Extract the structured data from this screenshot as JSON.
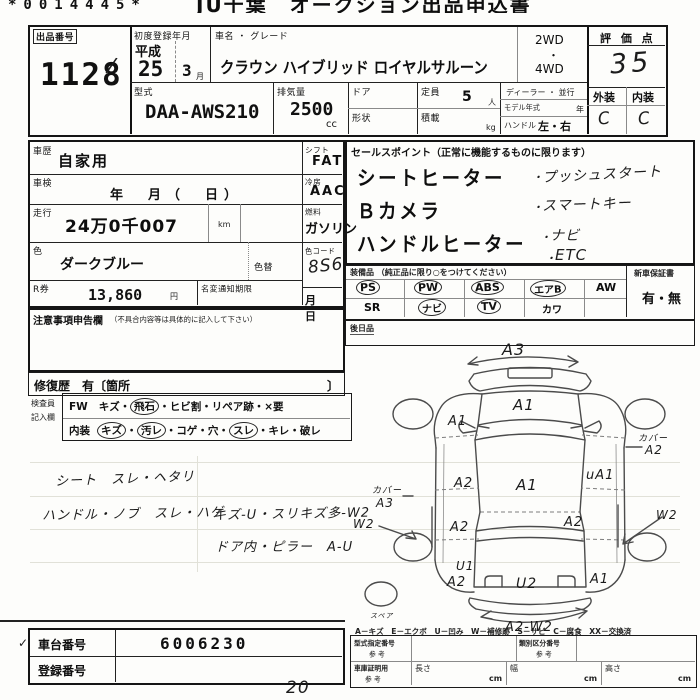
{
  "page": {
    "serial": "*0014445*",
    "title": "JU千葉　オークション出品申込書",
    "page_number": "20"
  },
  "head": {
    "lot_label": "出品番号",
    "lot": "1128",
    "check": "∕",
    "firstreg_label": "初度登録年月",
    "era": "平成",
    "year": "25",
    "month": "3",
    "month_unit": "月",
    "name_label": "車名 ・ グレード",
    "name": "クラウン ハイブリッド ロイヤルサルーン",
    "wd2": "2WD",
    "dot": "・",
    "wd4": "4WD",
    "score_label": "評 価 点",
    "score": "35",
    "model_label": "型式",
    "model": "DAA-AWS210",
    "disp_label": "排気量",
    "disp": "2500",
    "disp_unit": "cc",
    "door_label": "ドア",
    "shape_label": "形状",
    "cap_label": "定員",
    "cap": "5",
    "cap_unit": "人",
    "load_label": "積載",
    "load_unit": "kg",
    "dealer_label": "ディーラー ・ 並行",
    "modelyear_label": "モデル年式",
    "year_unit": "年",
    "handle_label": "ハンドル",
    "handle": "左・右",
    "ext_label": "外装",
    "int_label": "内装",
    "ext": "C",
    "int": "C"
  },
  "mid": {
    "history_label": "車歴",
    "history": "自家用",
    "shift_label": "シフト",
    "shift": "FAT",
    "shaken_label": "車検",
    "shaken": "年　月（　日）",
    "ac_label": "冷房",
    "ac": "AAC",
    "mileage_label": "走行",
    "mileage": "24万0千007",
    "mileage_unit": "km",
    "fuel_label": "燃料",
    "fuel": "ガソリン",
    "color_label": "色",
    "color": "ダークブルー",
    "colorchg_label": "色替",
    "colorcode_label": "色コード",
    "colorcode": "8S6",
    "rticket_label": "R券",
    "rticket": "13,860",
    "yen_unit": "円",
    "meihen_label": "名変通知期限",
    "meihen": "月　　日",
    "notes_label": "注意事項申告欄",
    "notes_sub": "（不具合内容等は具体的に記入して下さい）",
    "repair": "修復歴　有〔箇所",
    "repair_close": "〕"
  },
  "sales": {
    "header": "セールスポイント（正常に機能するものに限ります）",
    "printed": [
      "シートヒーター",
      "Ｂカメラ",
      "ハンドルヒーター"
    ],
    "bullet": "・",
    "written": [
      "プッシュスタート",
      "スマートキー",
      "ナビ",
      "ETC"
    ]
  },
  "equip": {
    "header": "装備品 （純正品に限り○をつけてください）",
    "row1": [
      "PS",
      "PW",
      "ABS",
      "エアB",
      "AW"
    ],
    "row2": [
      "SR",
      "ナビ",
      "TV",
      "カワ"
    ],
    "warranty_label": "新車保証書",
    "warranty": "有・無",
    "later_label": "後日品"
  },
  "inspector": {
    "who1": "検査員",
    "who2": "記入欄",
    "sep": "・",
    "fw": "FW",
    "fw_items": [
      "キズ",
      "飛石",
      "ヒビ割",
      "リペア跡",
      "×要"
    ],
    "interior": "内装",
    "int_items": [
      "キズ",
      "汚レ",
      "コゲ",
      "穴",
      "スレ",
      "キレ",
      "破レ"
    ]
  },
  "notes": [
    "シート　スレ・ヘタリ",
    "ハンドル・ノブ　スレ・ハゲ",
    "キズ-U・スリキズ多-W2",
    "ドア内・ピラー　A-U"
  ],
  "diagram": {
    "front_bumper": "A3",
    "hood": "A1",
    "left_fender": "A1",
    "roof": "A1",
    "left_front_door": "A2",
    "right_front_door": "uA1",
    "cover_right_l1": "カバー",
    "cover_right_l2": "A2",
    "cover_left_l1": "カバー",
    "cover_left_l2": "A3",
    "w2_left": "W2",
    "w2_right": "W2",
    "left_rear_door": "A2",
    "right_rear_door": "A2",
    "left_quarter_u": "U1",
    "left_quarter": "A2",
    "trunk": "U2",
    "right_quarter": "A1",
    "rear_bumper": "A2-W2",
    "spare": "スペア"
  },
  "legend": "A－キズ　E－エクボ　U－凹み　W－補修跡　S－サビ　C－腐食　XX－交換済",
  "bottom": {
    "chassis_label": "車台番号",
    "chassis": "6006230",
    "reg_label": "登録番号",
    "kata_label": "型式指定番号",
    "ref1": "参 考",
    "rui_label": "類別区分番号",
    "ref2": "参 考",
    "garage_label": "車庫証明用",
    "ref3": "参 考",
    "len_label": "長さ",
    "wid_label": "幅",
    "hei_label": "高さ",
    "cm": "cm"
  }
}
